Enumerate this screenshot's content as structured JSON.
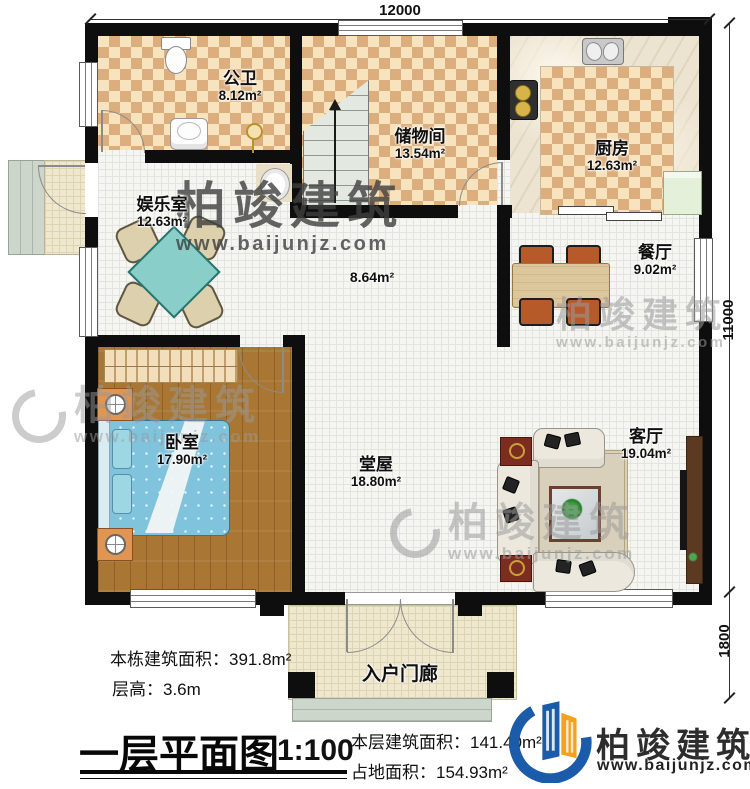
{
  "dimensions": {
    "top": "12000",
    "right": "11000",
    "porch_depth": "1800"
  },
  "rooms": {
    "bathroom": {
      "name": "公卫",
      "area": "8.12m²"
    },
    "storage": {
      "name": "储物间",
      "area": "13.54m²"
    },
    "kitchen": {
      "name": "厨房",
      "area": "12.63m²"
    },
    "entertainment": {
      "name": "娱乐室",
      "area": "12.63m²"
    },
    "dining": {
      "name": "餐厅",
      "area": "9.02m²"
    },
    "bedroom": {
      "name": "卧室",
      "area": "17.90m²"
    },
    "hall": {
      "area": "8.64m²"
    },
    "main_hall": {
      "name": "堂屋",
      "area": "18.80m²"
    },
    "living": {
      "name": "客厅",
      "area": "19.04m²"
    },
    "porch": {
      "name": "入户门廊"
    }
  },
  "info": {
    "building_total_area": "本栋建筑面积：391.8m²",
    "floor_height": "层高：3.6m",
    "plan_title": "一层平面图",
    "scale": "1:100",
    "floor_area": "本层建筑面积：141.40m²",
    "land_area": "占地面积：154.93m²"
  },
  "brand": {
    "name": "柏竣建筑",
    "url": "www.baijunjz.com"
  },
  "colors": {
    "wall": "#0e0e0e",
    "checker_dark": "#dcae7e",
    "checker_light": "#f7e3bd",
    "wood_floor": "#a97733",
    "logo_blue": "#1a5caa",
    "logo_orange": "#f2a21c"
  }
}
